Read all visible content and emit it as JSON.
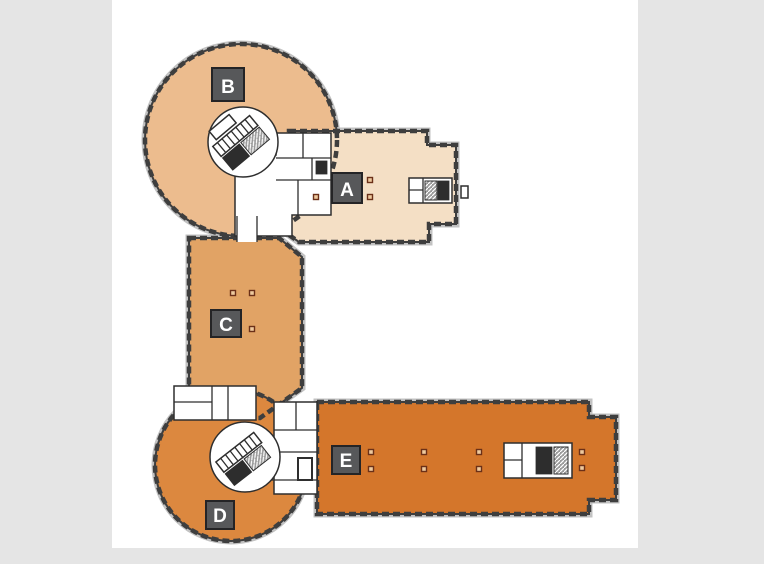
{
  "page": {
    "background_color": "#e5e5e5",
    "canvas_color": "#ffffff"
  },
  "floor_plan": {
    "type": "building-floor-plan",
    "wall_color": "#3e3e3e",
    "facade_outer_line_color": "#c2c2c2",
    "column_dot_fill": "#eeca9e",
    "column_dot_stroke": "#6b3018",
    "label_box": {
      "background": "#57585a",
      "border": "#242426",
      "text_color": "#ffffff"
    },
    "sections": [
      {
        "id": "A",
        "label": "A",
        "fill": "#f4dfc5"
      },
      {
        "id": "B",
        "label": "B",
        "fill": "#ecbc8e"
      },
      {
        "id": "C",
        "label": "C",
        "fill": "#e1a365"
      },
      {
        "id": "D",
        "label": "D",
        "fill": "#dc883f"
      },
      {
        "id": "E",
        "label": "E",
        "fill": "#d4762b"
      }
    ]
  }
}
